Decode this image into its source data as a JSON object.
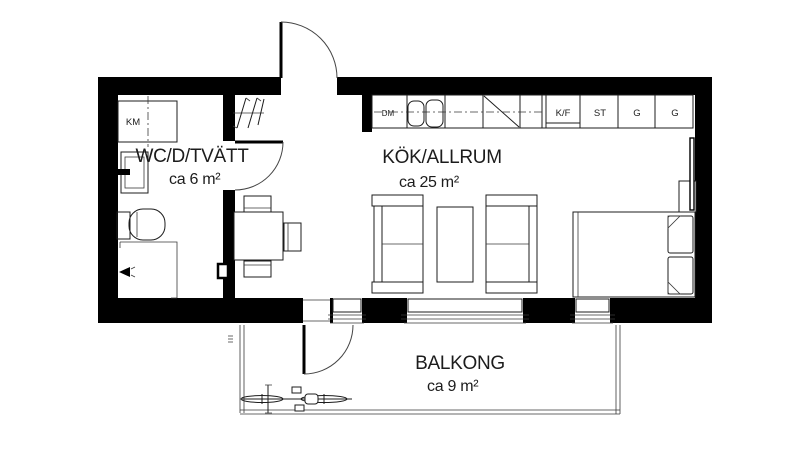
{
  "plan_title": "Apartment floor plan",
  "rooms": [
    {
      "name": "WC/D/TVÄTT",
      "area": "ca 6 m²"
    },
    {
      "name": "KÖK/ALLRUM",
      "area": "ca 25 m²"
    },
    {
      "name": "BALKONG",
      "area": "ca 9 m²"
    }
  ],
  "appliances": {
    "washer": "KM",
    "dishwasher": "DM",
    "fridge_freezer": "K/F",
    "cleaning_cabinet": "ST",
    "wardrobe_1": "G",
    "wardrobe_2": "G"
  },
  "colors": {
    "wall": "#000000",
    "line": "#1c1c1c",
    "background": "#ffffff"
  }
}
